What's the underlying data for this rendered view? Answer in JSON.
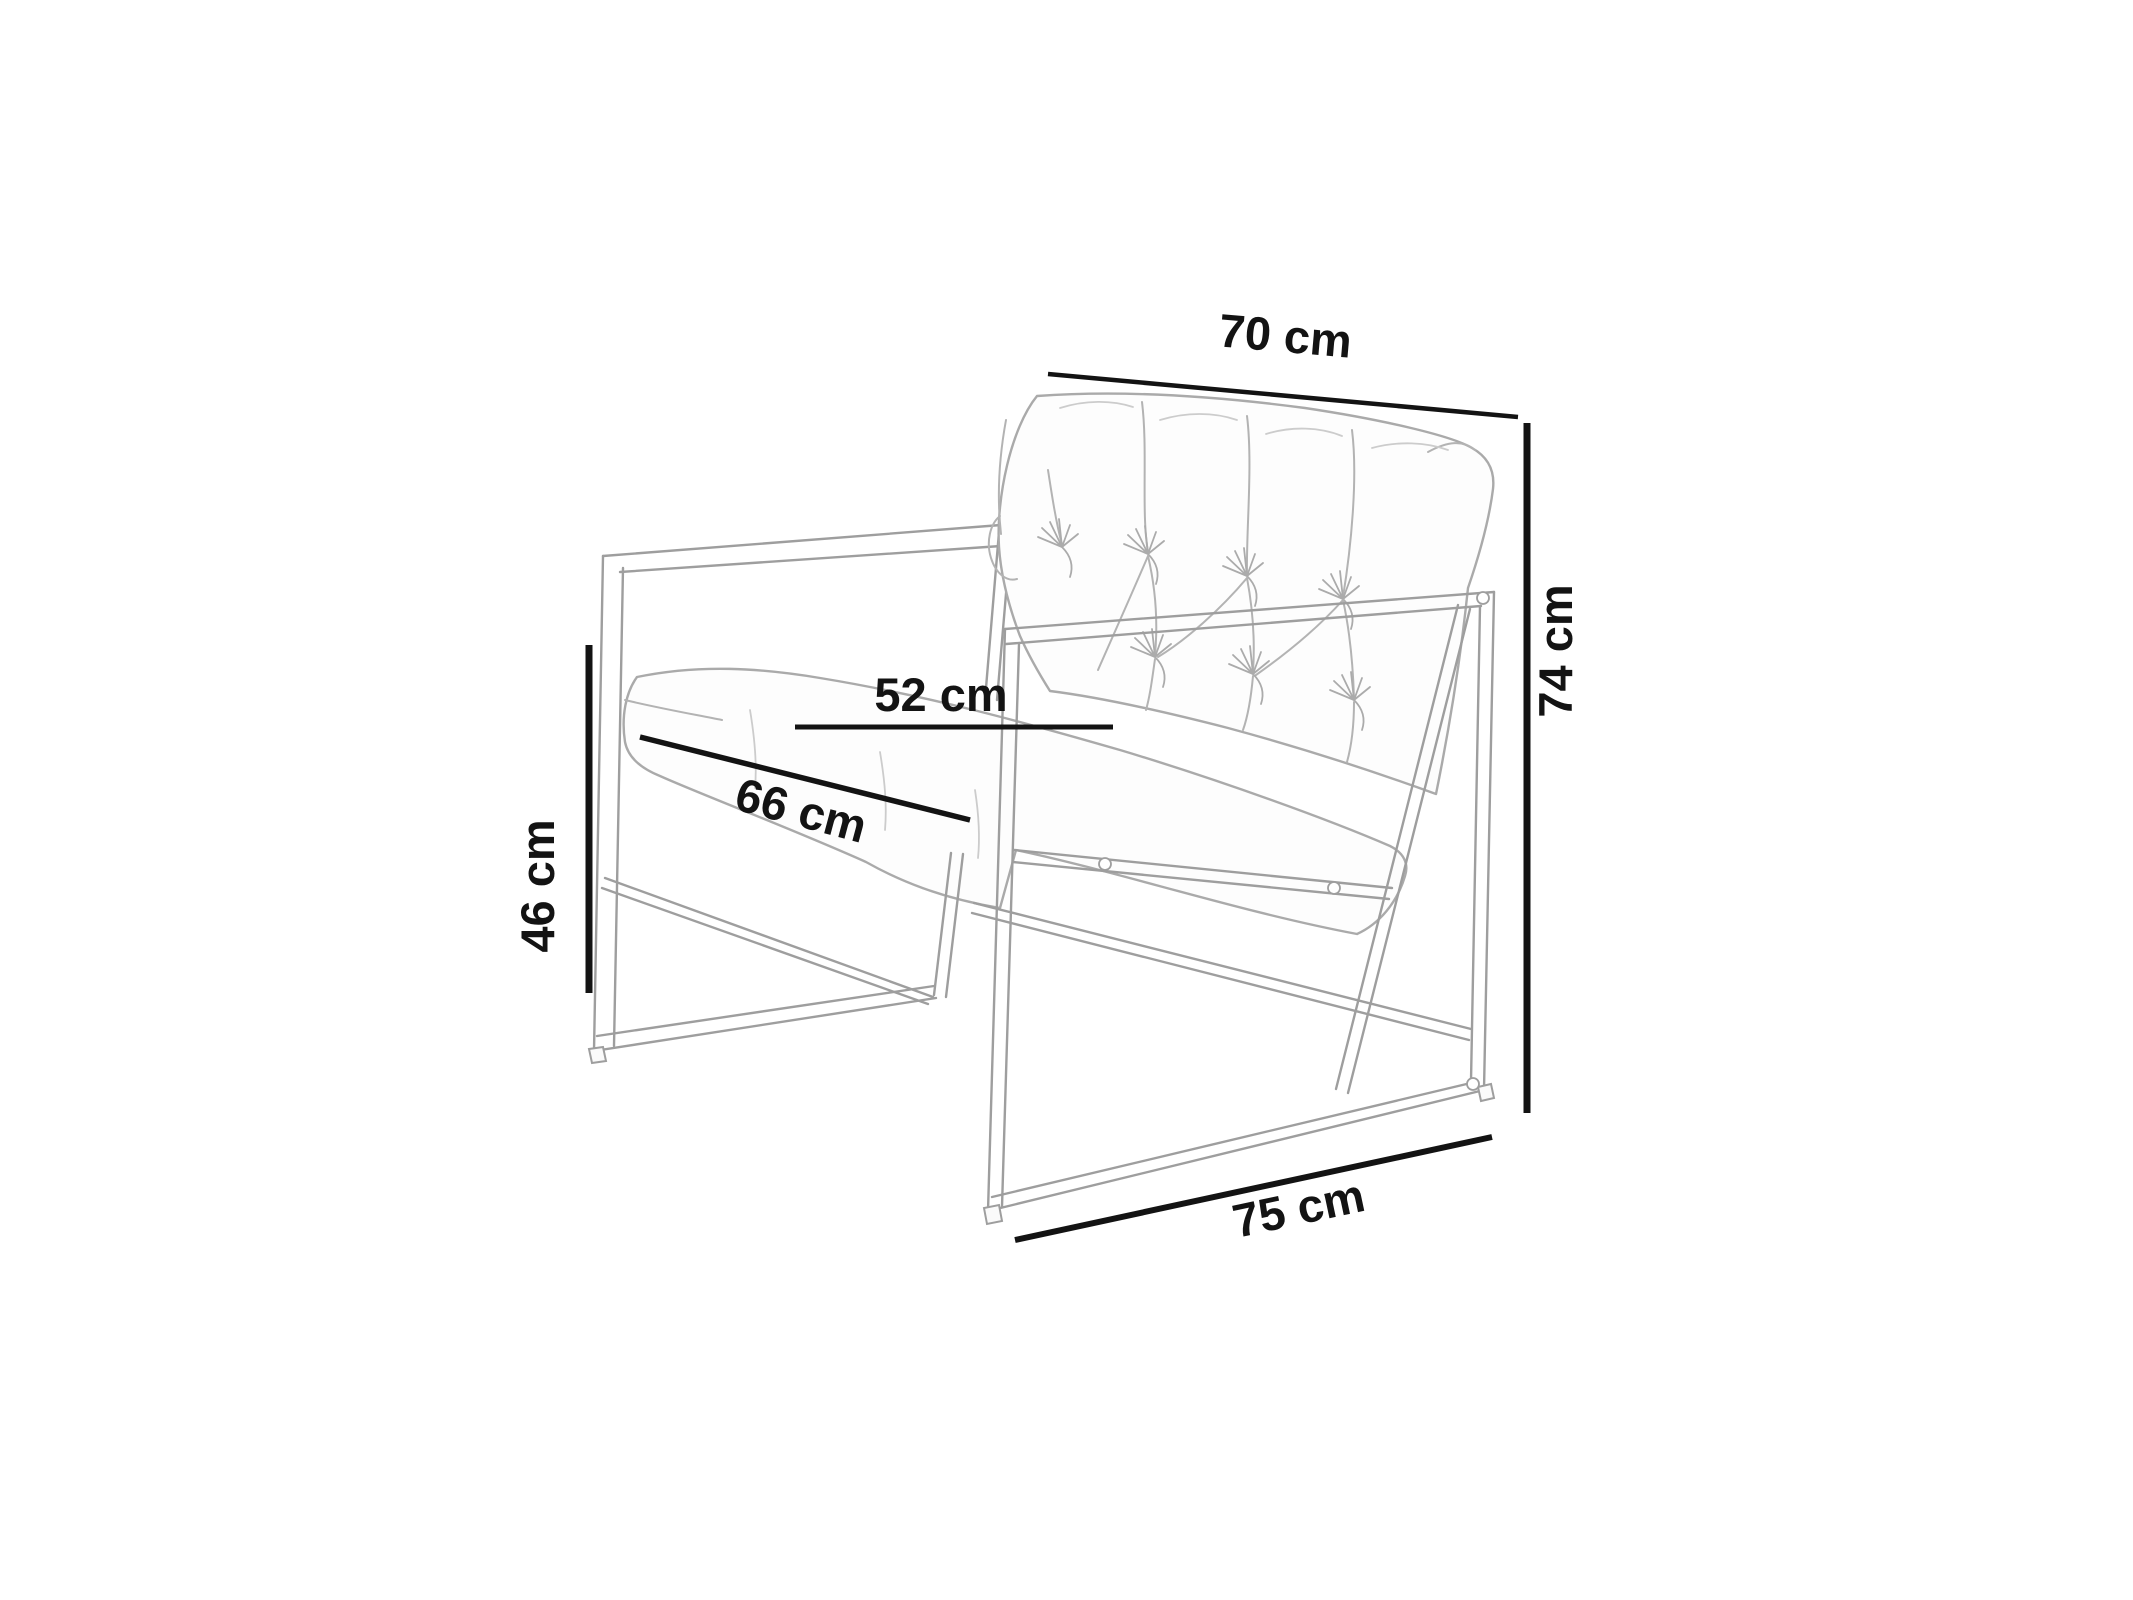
{
  "page": {
    "background_color": "#ffffff",
    "kind": "furniture dimension diagram",
    "subject": "metal-frame armchair with tufted back cushion, pencil-sketch style"
  },
  "diagram": {
    "unit": "cm",
    "sketch_color": "#9e9e9e",
    "annotation_color": "#131313",
    "dimensions": [
      {
        "id": "backrest-width",
        "label": "70 cm",
        "value": 70,
        "placement": "top, above backrest, slightly tilted"
      },
      {
        "id": "overall-height",
        "label": "74 cm",
        "value": 74,
        "placement": "right side, vertical line, rotated text"
      },
      {
        "id": "seat-height",
        "label": "46 cm",
        "value": 46,
        "placement": "left side, vertical line, rotated text"
      },
      {
        "id": "seat-width",
        "label": "52 cm",
        "value": 52,
        "placement": "middle, horizontal line across seat"
      },
      {
        "id": "seat-depth",
        "label": "66 cm",
        "value": 66,
        "placement": "middle, diagonal line along seat front edge"
      },
      {
        "id": "base-depth",
        "label": "75 cm",
        "value": 75,
        "placement": "bottom, diagonal line along base frame"
      }
    ]
  }
}
